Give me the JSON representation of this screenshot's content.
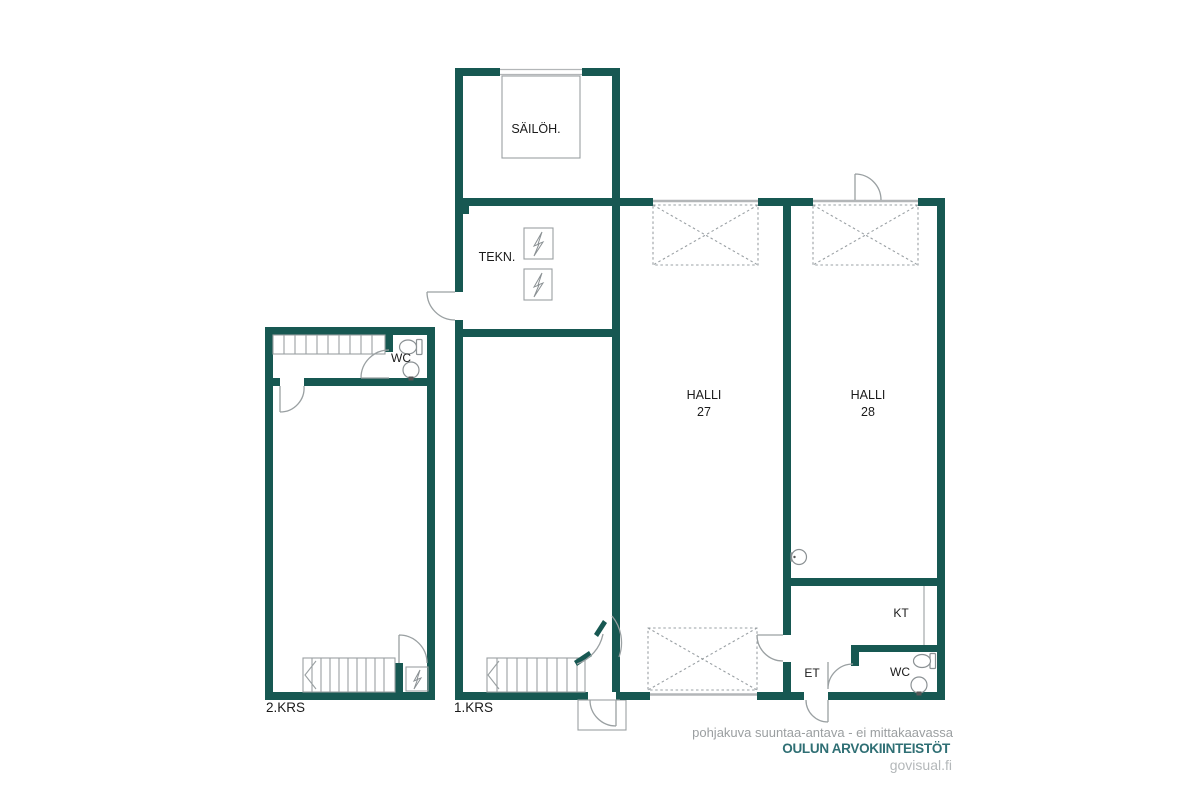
{
  "rooms": {
    "sailoh": {
      "label": "SÄILÖH."
    },
    "tekn": {
      "label": "TEKN."
    },
    "halli27": {
      "name": "HALLI",
      "number": "27"
    },
    "halli28": {
      "name": "HALLI",
      "number": "28"
    },
    "wc_upper": {
      "label": "WC"
    },
    "wc_lower": {
      "label": "WC"
    },
    "kt": {
      "label": "KT"
    },
    "et": {
      "label": "ET"
    }
  },
  "floors": {
    "left": "2.KRS",
    "center": "1.KRS"
  },
  "footer": {
    "disclaimer": "pohjakuva suuntaa-antava - ei mittakaavassa",
    "company": "OULUN ARVOKIINTEISTÖT",
    "website": "govisual.fi"
  },
  "colors": {
    "wall": "#175852",
    "line": "#9aa0a2",
    "opening_line": "#b3b6b8",
    "dashed_line": "#9aa0a4",
    "label_text": "#1b1b1b",
    "disclaimer_text": "#9b9fa1",
    "company_text": "#2f6f74",
    "website_text": "#b4b8ba"
  }
}
